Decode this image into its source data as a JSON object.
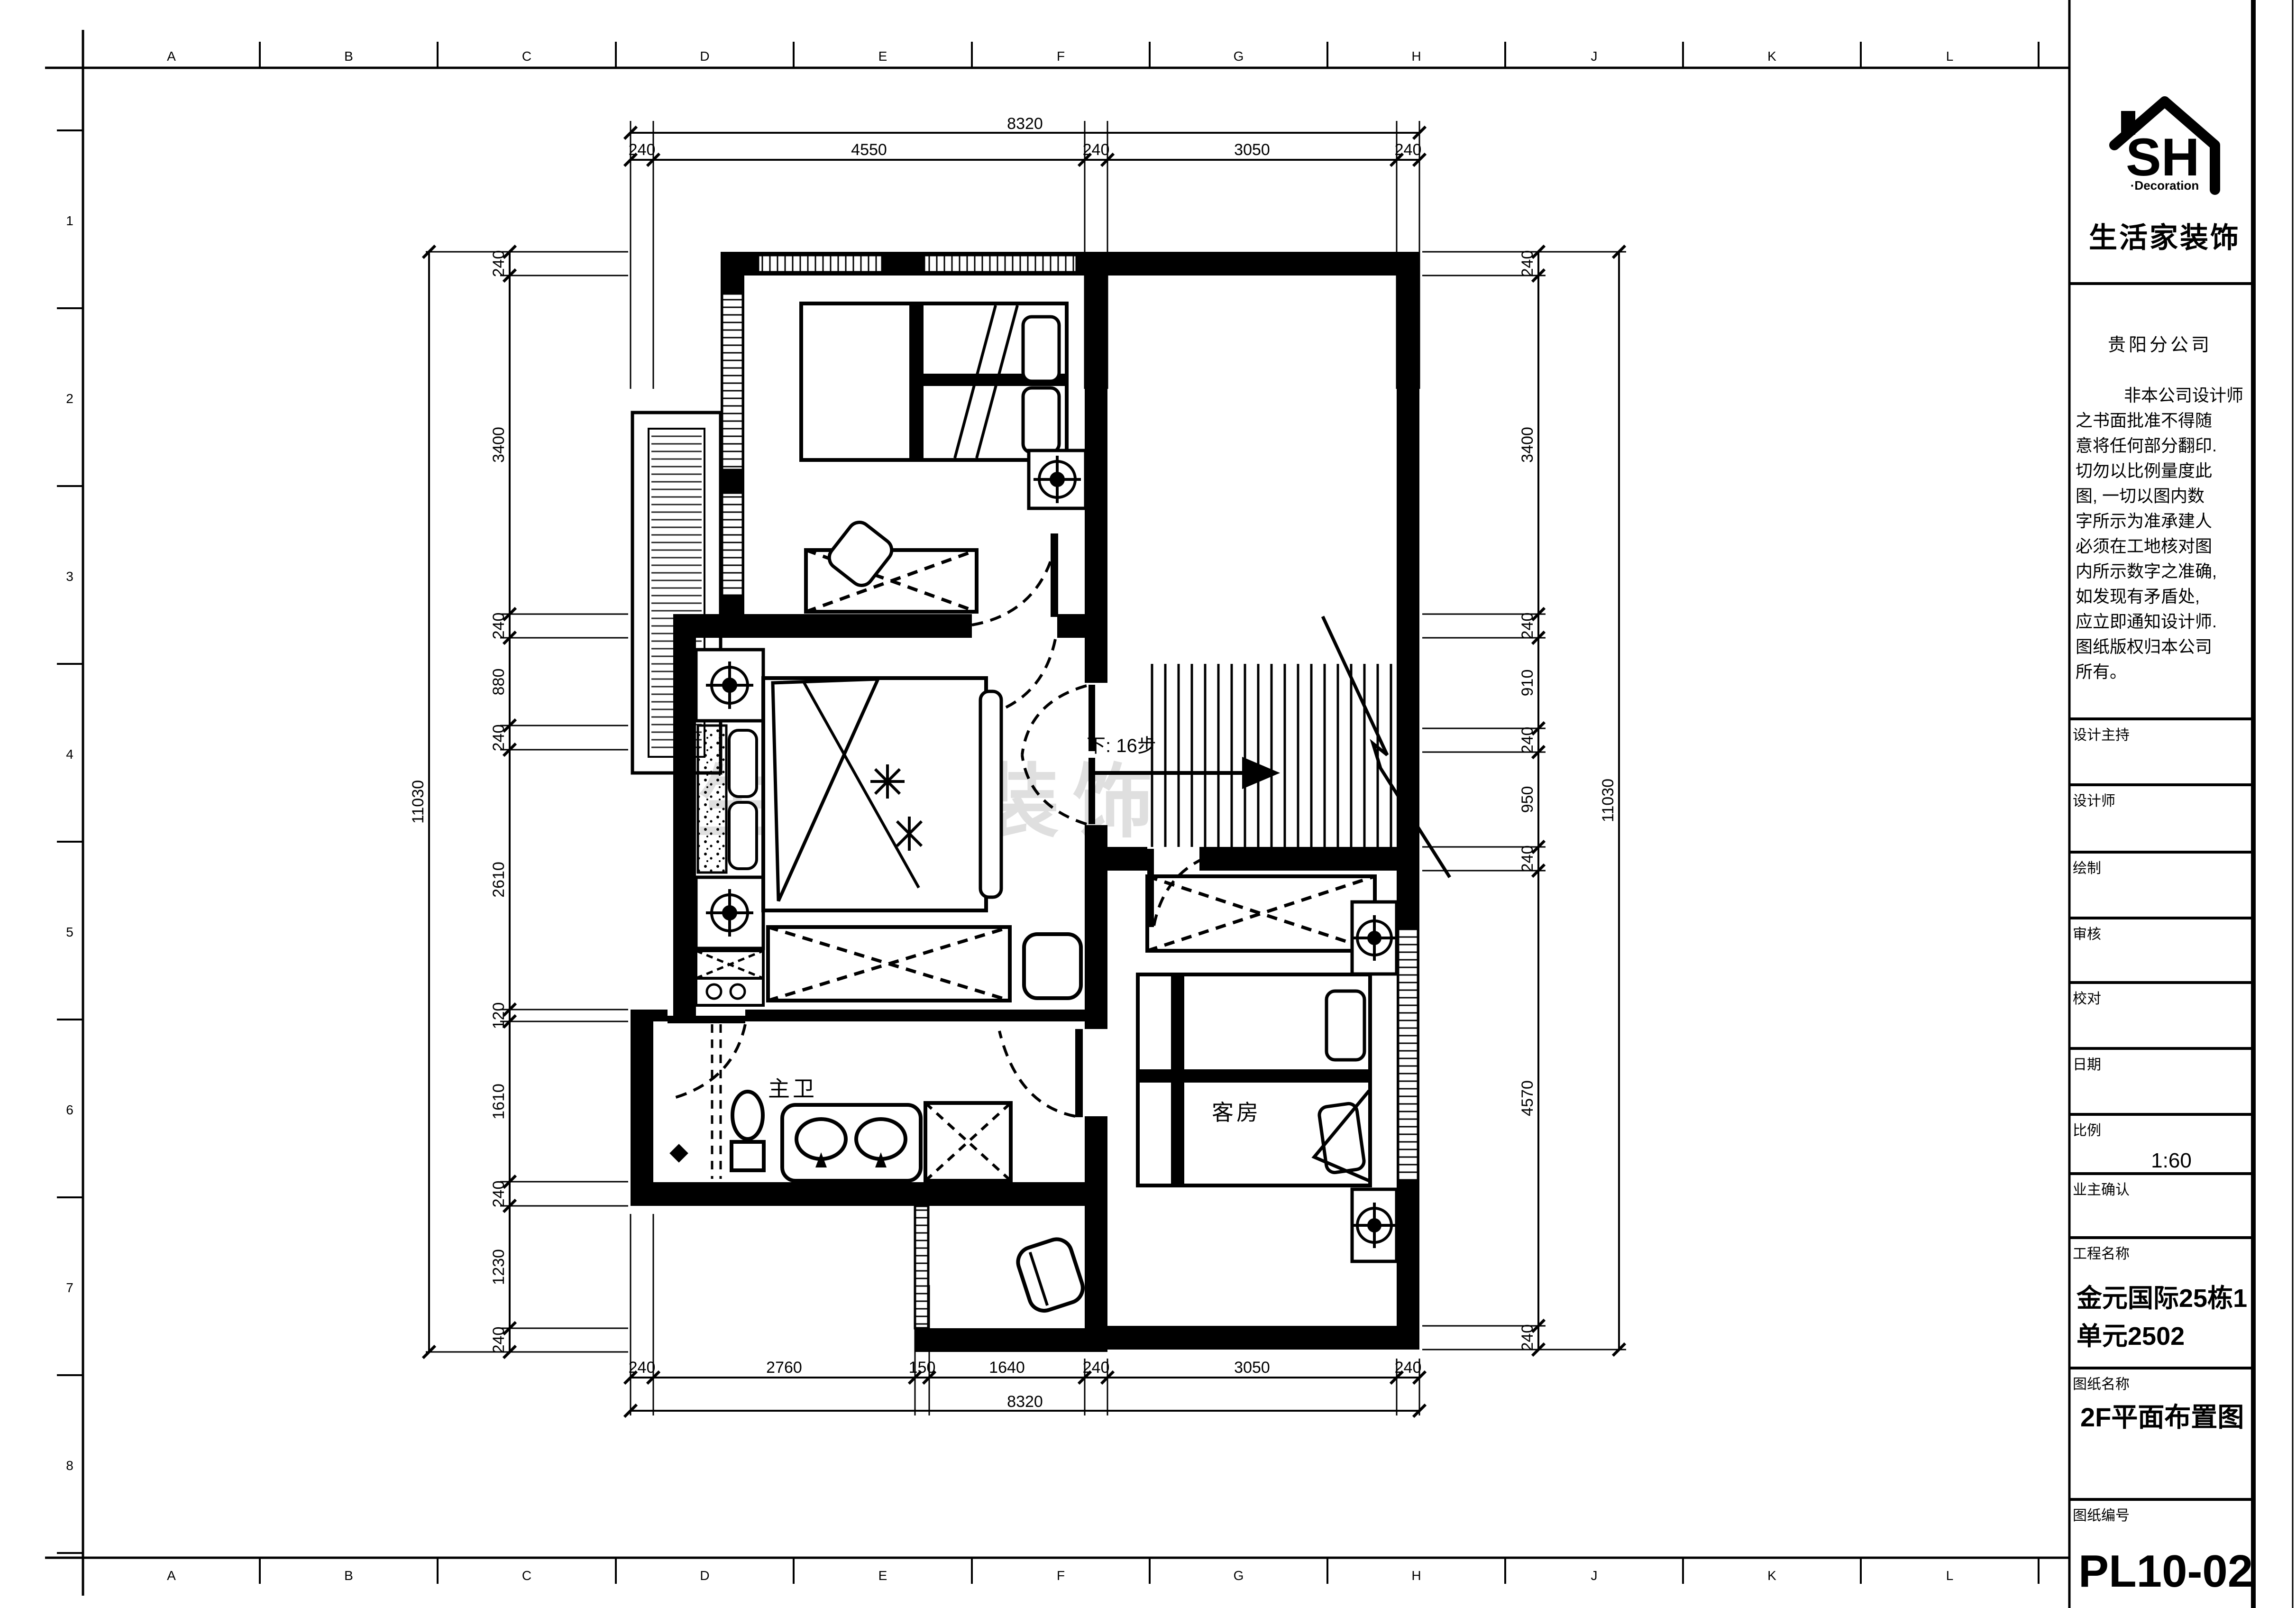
{
  "frame": {
    "top_letters": [
      "A",
      "B",
      "C",
      "D",
      "E",
      "F",
      "G",
      "H",
      "J",
      "K",
      "L"
    ],
    "bottom_letters": [
      "A",
      "B",
      "C",
      "D",
      "E",
      "F",
      "G",
      "H",
      "J",
      "K",
      "L"
    ],
    "left_numbers": [
      "1",
      "2",
      "3",
      "4",
      "5",
      "6",
      "7",
      "8"
    ]
  },
  "plan": {
    "labels": {
      "bathroom": "主卫",
      "guest_room": "客房",
      "stair_note": "下: 16步"
    },
    "watermark": "生活家装饰",
    "dims": {
      "top_total": "8320",
      "bottom_total": "8320",
      "left_total": "11030",
      "right_total": "11030",
      "top": [
        "240",
        "4550",
        "240",
        "3050",
        "240"
      ],
      "bottom": [
        "240",
        "2760",
        "150",
        "1640",
        "240",
        "3050",
        "240"
      ],
      "left": [
        "240",
        "3400",
        "240",
        "880",
        "240",
        "2610",
        "120",
        "1610",
        "240",
        "1230",
        "240"
      ],
      "right": [
        "240",
        "3400",
        "240",
        "910",
        "240",
        "950",
        "240",
        "4570",
        "240"
      ]
    }
  },
  "title_block": {
    "logo_text": "SH",
    "logo_sub": "·Decoration",
    "logo_company": "生活家装饰",
    "branch": "贵阳分公司",
    "disclaimer_lines": [
      "非本公司设计师",
      "之书面批准不得随",
      "意将任何部分翻印.",
      "切勿以比例量度此",
      "图, 一切以图内数",
      "字所示为准承建人",
      "必须在工地核对图",
      "内所示数字之准确,",
      "如发现有矛盾处,",
      "应立即通知设计师.",
      "图纸版权归本公司",
      "所有。"
    ],
    "fields": {
      "design_director": "设计主持",
      "designer": "设计师",
      "drafter": "绘制",
      "reviewer": "审核",
      "proofreader": "校对",
      "date": "日期",
      "scale_label": "比例",
      "scale_value": "1:60",
      "owner_confirm": "业主确认",
      "project_label": "工程名称",
      "project_line1": "金元国际25栋1",
      "project_line2": "单元2502",
      "sheet_label": "图纸名称",
      "sheet_name": "2F平面布置图",
      "number_label": "图纸编号",
      "sheet_number": "PL10-02"
    }
  }
}
